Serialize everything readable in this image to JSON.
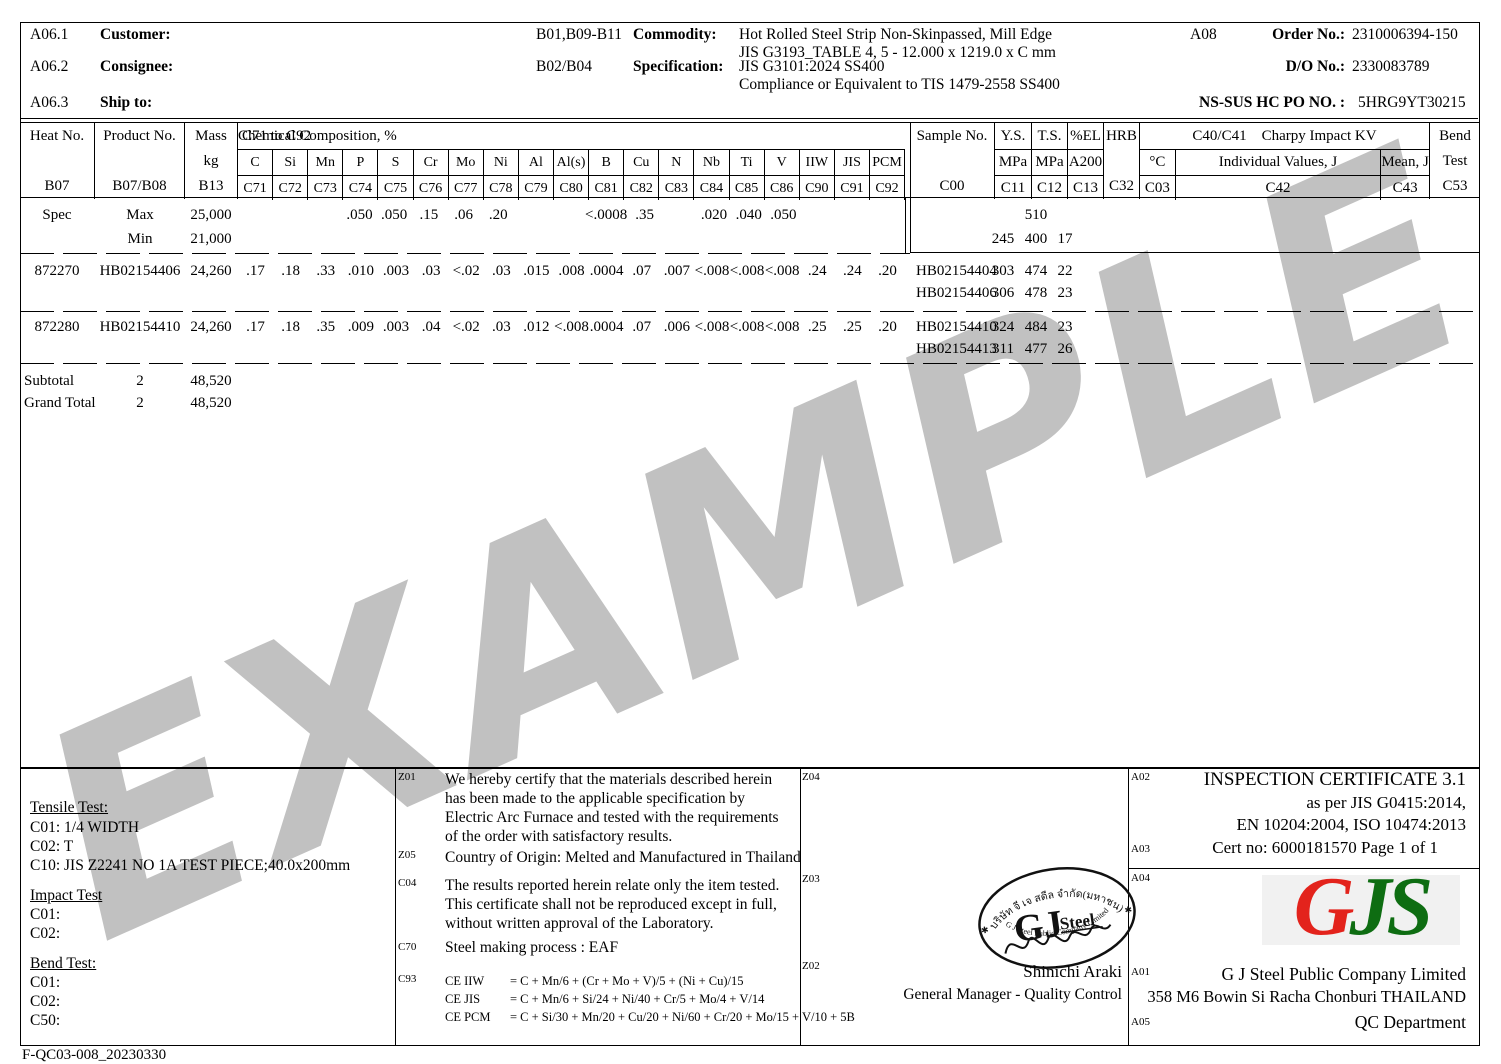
{
  "watermark": "EXAMPLE",
  "header": {
    "a061": "A06.1",
    "customer_label": "Customer:",
    "a062": "A06.2",
    "consignee_label": "Consignee:",
    "a063": "A06.3",
    "shipto_label": "Ship to:",
    "b01": "B01,B09-B11",
    "commodity_label": "Commodity:",
    "commodity1": "Hot Rolled Steel Strip Non-Skinpassed, Mill Edge",
    "commodity2": "JIS G3193_TABLE 4, 5 - 12.000 x 1219.0 x C mm",
    "b02": "B02/B04",
    "specification_label": "Specification:",
    "spec1": "JIS G3101:2024 SS400",
    "spec2": "Compliance or Equivalent to TIS 1479-2558 SS400",
    "a08": "A08",
    "order_label": "Order No.:",
    "order_no": "2310006394-150",
    "do_label": "D/O No.:",
    "do_no": "2330083789",
    "po_label": "NS-SUS HC PO NO. :",
    "po_no": "5HRG9YT30215"
  },
  "thead": {
    "heat": {
      "l1": "Heat No.",
      "l3": "B07"
    },
    "product": {
      "l1": "Product No.",
      "l3": "B07/B08"
    },
    "mass": {
      "l1": "Mass",
      "l2": "kg",
      "l3": "B13"
    },
    "chem_range": "C71 to C92",
    "chem_title": "Chemical Composition, %",
    "chem_cols": [
      {
        "sym": "C",
        "code": "C71"
      },
      {
        "sym": "Si",
        "code": "C72"
      },
      {
        "sym": "Mn",
        "code": "C73"
      },
      {
        "sym": "P",
        "code": "C74"
      },
      {
        "sym": "S",
        "code": "C75"
      },
      {
        "sym": "Cr",
        "code": "C76"
      },
      {
        "sym": "Mo",
        "code": "C77"
      },
      {
        "sym": "Ni",
        "code": "C78"
      },
      {
        "sym": "Al",
        "code": "C79"
      },
      {
        "sym": "Al(s)",
        "code": "C80"
      },
      {
        "sym": "B",
        "code": "C81"
      },
      {
        "sym": "Cu",
        "code": "C82"
      },
      {
        "sym": "N",
        "code": "C83"
      },
      {
        "sym": "Nb",
        "code": "C84"
      },
      {
        "sym": "Ti",
        "code": "C85"
      },
      {
        "sym": "V",
        "code": "C86"
      },
      {
        "sym": "IIW",
        "code": "C90"
      },
      {
        "sym": "JIS",
        "code": "C91"
      },
      {
        "sym": "PCM",
        "code": "C92"
      }
    ],
    "sample": {
      "l1": "Sample No.",
      "l3": "C00"
    },
    "ys": {
      "l1": "Y.S.",
      "l2": "MPa",
      "l3": "C11"
    },
    "ts": {
      "l1": "T.S.",
      "l2": "MPa",
      "l3": "C12"
    },
    "el": {
      "l1": "%EL",
      "l2": "A200",
      "l3": "C13"
    },
    "hrb": {
      "l1": "HRB",
      "l3": "C32"
    },
    "charpy_code": "C40/C41",
    "charpy_title": "Charpy Impact KV",
    "degc": {
      "l2": "°C",
      "l3": "C03"
    },
    "individual": {
      "l2": "Individual Values, J",
      "l3": "C42"
    },
    "mean": {
      "l2": "Mean, J",
      "l3": "C43"
    },
    "bend": {
      "l1": "Bend",
      "l2": "Test",
      "l3": "C53"
    }
  },
  "spec": {
    "label": "Spec",
    "max_label": "Max",
    "min_label": "Min",
    "mass_max": "25,000",
    "mass_min": "21,000",
    "chem_max": [
      "",
      "",
      "",
      ".050",
      ".050",
      ".15",
      ".06",
      ".20",
      "",
      "",
      "<.0008",
      ".35",
      "",
      ".020",
      ".040",
      ".050",
      "",
      "",
      ""
    ],
    "ts_max": "510",
    "ys_min": "245",
    "ts_min": "400",
    "el_min": "17"
  },
  "rows": [
    {
      "heat": "872270",
      "product": "HB02154406",
      "mass": "24,260",
      "chem": [
        ".17",
        ".18",
        ".33",
        ".010",
        ".003",
        ".03",
        "<.02",
        ".03",
        ".015",
        ".008",
        ".0004",
        ".07",
        ".007",
        "<.008",
        "<.008",
        "<.008",
        ".24",
        ".24",
        ".20"
      ],
      "samples": [
        {
          "no": "HB02154404",
          "ys": "303",
          "ts": "474",
          "el": "22"
        },
        {
          "no": "HB02154406",
          "ys": "306",
          "ts": "478",
          "el": "23"
        }
      ]
    },
    {
      "heat": "872280",
      "product": "HB02154410",
      "mass": "24,260",
      "chem": [
        ".17",
        ".18",
        ".35",
        ".009",
        ".003",
        ".04",
        "<.02",
        ".03",
        ".012",
        "<.008",
        ".0004",
        ".07",
        ".006",
        "<.008",
        "<.008",
        "<.008",
        ".25",
        ".25",
        ".20"
      ],
      "samples": [
        {
          "no": "HB02154410",
          "ys": "324",
          "ts": "484",
          "el": "23"
        },
        {
          "no": "HB02154413",
          "ys": "311",
          "ts": "477",
          "el": "26"
        }
      ]
    }
  ],
  "totals": {
    "subtotal_label": "Subtotal",
    "subtotal_count": "2",
    "subtotal_mass": "48,520",
    "grand_label": "Grand Total",
    "grand_count": "2",
    "grand_mass": "48,520"
  },
  "left_panel": {
    "tensile_title": "Tensile Test:",
    "t1": "C01:  1/4 WIDTH",
    "t2": "C02:  T",
    "t3": "C10:  JIS Z2241 NO 1A TEST PIECE;40.0x200mm",
    "impact_title": "Impact Test",
    "i1": "C01:",
    "i2": "C02:",
    "bend_title": "Bend Test:",
    "b1": "C01:",
    "b2": "C02:",
    "b3": "C50:"
  },
  "notes": {
    "z01_label": "Z01",
    "z01_lines": [
      "We hereby certify that the materials described herein",
      "has been made to the applicable specification by",
      "Electric Arc Furnace and tested with the requirements",
      "of the order with satisfactory results."
    ],
    "z05_label": "Z05",
    "z05_text": "Country of Origin: Melted and Manufactured in Thailand",
    "c04_label": "C04",
    "c04_lines": [
      "The results reported herein relate only the item tested.",
      "This certificate shall not be reproduced except in full,",
      "without written approval of the Laboratory."
    ],
    "c70_label": "C70",
    "c70_text": "Steel making process : EAF",
    "c93_label": "C93",
    "c93_rows": [
      {
        "name": "CE IIW",
        "f": "= C + Mn/6 + (Cr + Mo + V)/5 + (Ni + Cu)/15"
      },
      {
        "name": "CE JIS",
        "f": "= C + Mn/6 + Si/24 + Ni/40 + Cr/5 + Mo/4 + V/14"
      },
      {
        "name": "CE PCM",
        "f": "= C + Si/30 + Mn/20 + Cu/20 + Ni/60 + Cr/20 + Mo/15 + V/10 + 5B"
      }
    ]
  },
  "sign": {
    "z04_label": "Z04",
    "z03_label": "Z03",
    "z02_label": "Z02",
    "name": "Shinichi Araki",
    "title": "General Manager - Quality Control"
  },
  "stamp": {
    "thai": "บริษัท จี เจ สตีล จำกัด(มหาชน)",
    "ring": "G J Steel Public Company Limited",
    "gj": "GJ",
    "steel": "Steel",
    "star_left": "✱",
    "star_right": "✱"
  },
  "cert": {
    "a02_label": "A02",
    "line1": "INSPECTION CERTIFICATE 3.1",
    "line2": "as per JIS G0415:2014,",
    "line3": "EN 10204:2004, ISO 10474:2013",
    "a03_label": "A03",
    "certno": "Cert no: 6000181570 Page 1  of 1"
  },
  "company": {
    "a04_label": "A04",
    "logo_g": "G",
    "logo_js": "JS",
    "a01_label": "A01",
    "name": "G J Steel  Public Company Limited",
    "address": "358 M6 Bowin Si Racha Chonburi THAILAND",
    "a05_label": "A05",
    "dept": "QC Department"
  },
  "footer": "F-QC03-008_20230330"
}
